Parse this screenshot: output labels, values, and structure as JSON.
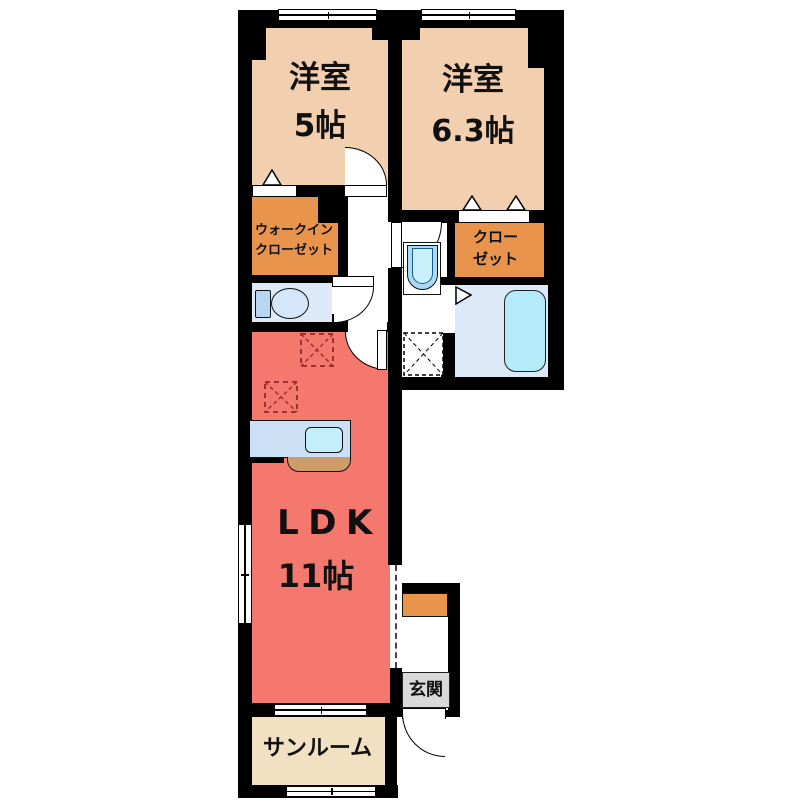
{
  "title": "1LDK floor plan",
  "rooms": {
    "bedroom5": {
      "name": "洋室",
      "size": "5帖"
    },
    "bedroom63": {
      "name": "洋室",
      "size": "6.3帖"
    },
    "wic": {
      "line1": "ウォークイン",
      "line2": "クローゼット"
    },
    "closet": {
      "line1": "クロー",
      "line2": "ゼット"
    },
    "ldk": {
      "name": "LDK",
      "size": "11帖"
    },
    "entrance": {
      "name": "玄関"
    },
    "sunroom": {
      "name": "サンルーム"
    }
  },
  "fixtures": [
    "toilet",
    "washbasin",
    "bathtub",
    "kitchen-sink",
    "washing-machine-pan",
    "shoe-cabinet"
  ],
  "colors": {
    "wall": "#000000",
    "bedroom": "#f2cfae",
    "closet": "#e8944d",
    "ldk": "#f4786e",
    "sunroom": "#f1e1c2",
    "wet_floor": "#dbe9f8",
    "fixture_blue": "#b3ebf8",
    "fixture_blue_dark": "#b8d5f2",
    "counter": "#cbdff5",
    "counter_trim": "#cf9b68",
    "entrance_label_bg": "#d9d9d9"
  }
}
